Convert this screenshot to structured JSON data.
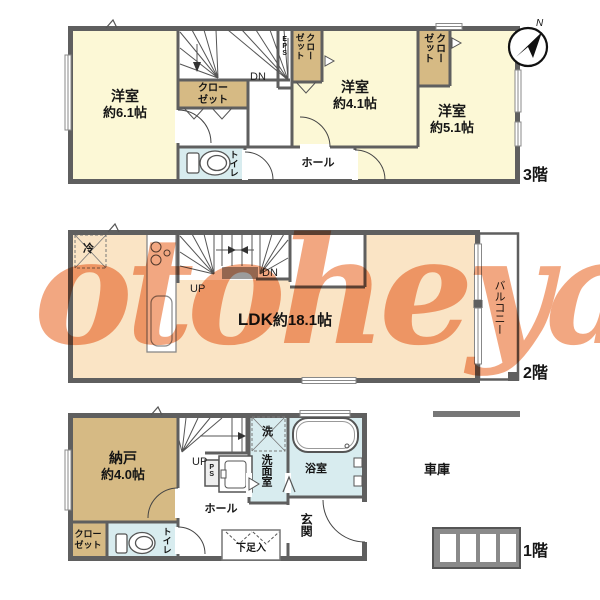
{
  "watermark": "otoheya",
  "colors": {
    "wall": "#5f5f5f",
    "room_cream": "#fcf8d6",
    "room_tan": "#d6ba84",
    "room_blue": "#d8ecef",
    "room_peach": "#fae4c5",
    "watermark_orange": "#ee8e5e",
    "landing_gray": "#9c9c9c"
  },
  "floor3": {
    "floor_label": "3階",
    "compass_n": "N",
    "room_61_name": "洋室",
    "room_61_size": "約6.1帖",
    "room_41_name": "洋室",
    "room_41_size": "約4.1帖",
    "room_51_name": "洋室",
    "room_51_size": "約5.1帖",
    "closet_main": "クロー\nゼット",
    "closet_a": "クロー\nゼット",
    "closet_b": "クロー\nゼット",
    "eps": "EPS",
    "dn": "DN",
    "hall": "ホール",
    "toilet": "トイレ"
  },
  "floor2": {
    "floor_label": "2階",
    "ldk_name": "LDK",
    "ldk_size": "約18.1帖",
    "fridge": "冷",
    "up": "UP",
    "dn": "DN",
    "balcony": "バルコニー"
  },
  "floor1": {
    "floor_label": "1階",
    "storage_name": "納戸",
    "storage_size": "約4.0帖",
    "closet": "クロー\nゼット",
    "toilet": "トイレ",
    "up": "UP",
    "ps": "PS",
    "hall": "ホール",
    "shoe_box": "下足入",
    "washer": "洗",
    "washroom": "洗面室",
    "bathroom": "浴室",
    "entrance": "玄関",
    "garage": "車庫"
  }
}
